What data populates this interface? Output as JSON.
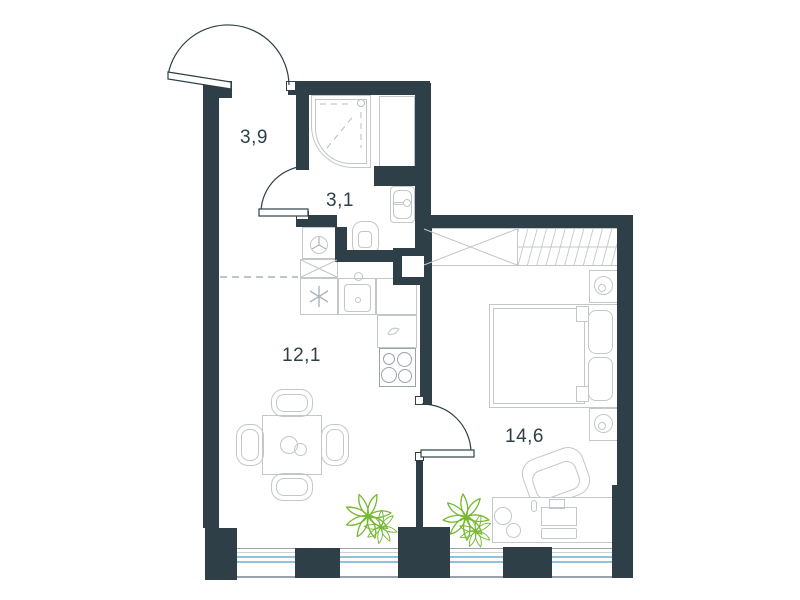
{
  "plan_title": "apartment-floor-plan",
  "rooms": [
    {
      "name": "hallway",
      "area": "3,9"
    },
    {
      "name": "bathroom",
      "area": "3,1"
    },
    {
      "name": "kitchen-living-room",
      "area": "12,1"
    },
    {
      "name": "bedroom",
      "area": "14,6"
    }
  ],
  "colors": {
    "wall": "#2e3f47",
    "furniture_outline": "#c3c7c9",
    "fixture_outline": "#9aa4a8",
    "window_glass": "#8fc3dc",
    "plant": "#76b832",
    "label_text": "#2e3f47",
    "background": "#ffffff"
  },
  "fixtures": {
    "hallway": [
      "entrance-door"
    ],
    "bathroom": [
      "shower-cabin",
      "ventilation-shaft",
      "wash-basin",
      "toilet",
      "washing-machine",
      "bathroom-door"
    ],
    "kitchen_living_room": [
      "tall-cabinet",
      "appliance-cabinet",
      "kitchen-sink",
      "corner-counter",
      "cooktop",
      "dining-table",
      "dining-chairs",
      "plant",
      "ceiling-zone-dashed-line"
    ],
    "bedroom": [
      "wardrobe",
      "wardrobe-rail-section",
      "nightstand-with-lamp",
      "double-bed",
      "pillows",
      "desk",
      "laptop",
      "desk-chair",
      "plant",
      "room-door"
    ],
    "exterior": [
      "window-strip",
      "window-pillars"
    ]
  }
}
